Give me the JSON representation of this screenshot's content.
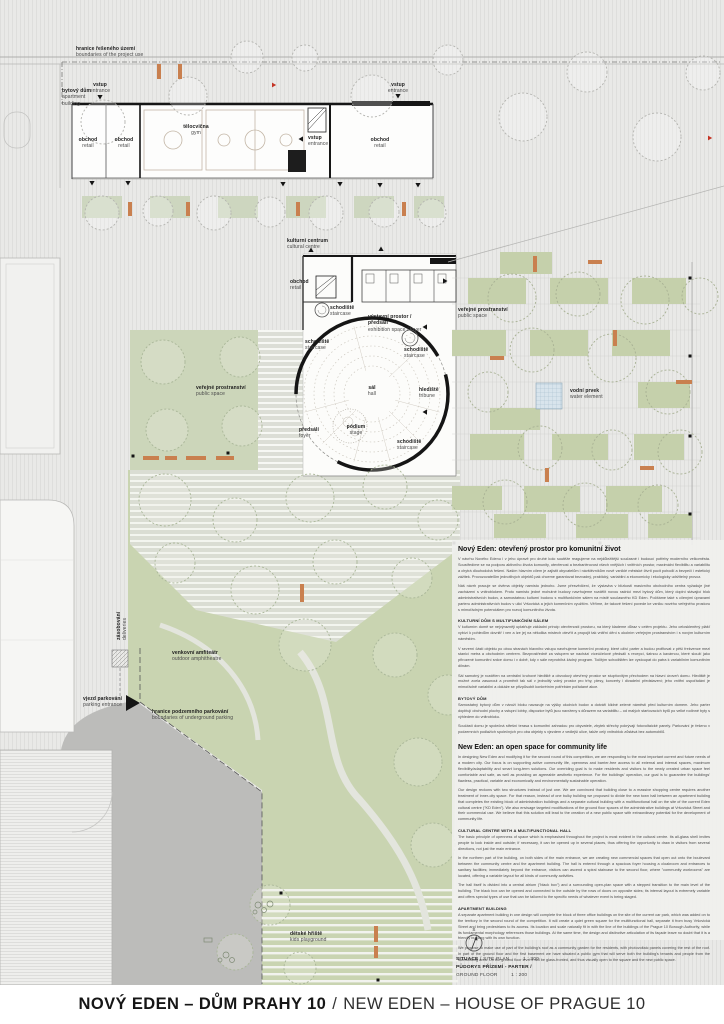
{
  "title_bar": {
    "cz": "NOVÝ EDEN – DŮM PRAHY 10",
    "separator": "/",
    "en": "NEW EDEN – HOUSE OF PRAGUE 10"
  },
  "scale_block": {
    "north_letter": "S",
    "situace_cz": "SITUACE",
    "situace_en": "/ SITE PLAN",
    "situace_scale": "1 : 300",
    "pudorys_cz": "PŮDORYS PŘÍZEMÍ - PARTER /",
    "pudorys_en": "GROUND FLOOR",
    "pudorys_scale": "1 : 200"
  },
  "plan": {
    "labels": [
      {
        "id": "project-boundary",
        "cz": "hranice řešeného území",
        "en": "boundaries of the project use",
        "x": 76,
        "y": 46
      },
      {
        "id": "apartment-building",
        "cz": "bytový dům",
        "en": "apartment building",
        "x": 62,
        "y": 88,
        "w": 34
      },
      {
        "id": "entrance-apartment",
        "cz": "vstup",
        "en": "entrance",
        "x": 100,
        "y": 82,
        "cls": "center"
      },
      {
        "id": "retail-1",
        "cz": "obchod",
        "en": "retail",
        "x": 88,
        "y": 137,
        "cls": "center"
      },
      {
        "id": "retail-2",
        "cz": "obchod",
        "en": "retail",
        "x": 124,
        "y": 137,
        "cls": "center"
      },
      {
        "id": "gym",
        "cz": "tělocvična",
        "en": "gym",
        "x": 196,
        "y": 124,
        "cls": "center"
      },
      {
        "id": "entrance-top-right",
        "cz": "vstup",
        "en": "entrance",
        "x": 398,
        "y": 82,
        "cls": "center"
      },
      {
        "id": "retail-3",
        "cz": "obchod",
        "en": "retail",
        "x": 380,
        "y": 137,
        "cls": "center"
      },
      {
        "id": "entrance-side",
        "cz": "vstup",
        "en": "entrance",
        "x": 308,
        "y": 135
      },
      {
        "id": "cultural-centre",
        "cz": "kulturní centrum",
        "en": "cultural centre",
        "x": 287,
        "y": 238
      },
      {
        "id": "retail-cc",
        "cz": "obchod",
        "en": "retail",
        "x": 290,
        "y": 279
      },
      {
        "id": "exhibition-space",
        "cz": "výstavní prostor / předsálí",
        "en": "exhibition space / foyer",
        "x": 368,
        "y": 314,
        "w": 62
      },
      {
        "id": "staircase-top",
        "cz": "schodiště",
        "en": "staircase",
        "x": 330,
        "y": 305
      },
      {
        "id": "staircase-left",
        "cz": "schodiště",
        "en": "staircase",
        "x": 305,
        "y": 339
      },
      {
        "id": "staircase-spiral",
        "cz": "schodiště",
        "en": "staircase",
        "x": 404,
        "y": 347
      },
      {
        "id": "tribune",
        "cz": "hlediště",
        "en": "tribune",
        "x": 419,
        "y": 387
      },
      {
        "id": "hall",
        "cz": "sál",
        "en": "hall",
        "x": 372,
        "y": 385,
        "cls": "center"
      },
      {
        "id": "stage",
        "cz": "pódium",
        "en": "stage",
        "x": 356,
        "y": 424,
        "cls": "center"
      },
      {
        "id": "foyer",
        "cz": "předsálí",
        "en": "foyer",
        "x": 299,
        "y": 427
      },
      {
        "id": "staircase-br",
        "cz": "schodiště",
        "en": "staircase",
        "x": 397,
        "y": 439
      },
      {
        "id": "public-space-right",
        "cz": "veřejné prostranství",
        "en": "public space",
        "x": 458,
        "y": 307
      },
      {
        "id": "public-space-left",
        "cz": "veřejné prostranství",
        "en": "public space",
        "x": 196,
        "y": 385
      },
      {
        "id": "water-element",
        "cz": "vodní prvek",
        "en": "water element",
        "x": 570,
        "y": 388
      },
      {
        "id": "deliveries",
        "cz": "zásobování",
        "en": "deliveries",
        "x": 116,
        "y": 640,
        "cls": "vert"
      },
      {
        "id": "outdoor-amphitheatre",
        "cz": "venkovní amfiteátr",
        "en": "outdoor amphitheatre",
        "x": 172,
        "y": 650
      },
      {
        "id": "parking-entrance",
        "cz": "vjezd parkování",
        "en": "parking entrance",
        "x": 58,
        "y": 696,
        "w": 64,
        "cls": "rightalign"
      },
      {
        "id": "underground-parking-boundary",
        "cz": "hranice podzemního parkování",
        "en": "boundaries of underground parking",
        "x": 152,
        "y": 709
      },
      {
        "id": "kids-playground",
        "cz": "dětské hřiště",
        "en": "kids playground",
        "x": 290,
        "y": 931
      }
    ]
  },
  "text_column": {
    "blocks": [
      {
        "type": "title",
        "text": "Nový Eden: otevřený prostor pro komunitní život"
      },
      {
        "type": "p",
        "text": "V návrhu Nového Edenu i v jeho úpravě pro druhé kolo soutěže reagujeme na nejdůležitější současné i budoucí potřeby moderního velkoměsta. Soustředíme se na podporu aktivního života komunity, otevřenost a bezbariérovost všech vnějších i vnitřních prostor, maximální flexibilitu a variabilitu a chytrá dlouhodobá řešení. Naším hlavním cílem je zajistit obyvatelům i návštěvníkům nově vzniklé městské čtvrti pocit pohodlí a bezpečí i estetický zážitek. Provozovatelům jednotlivých objektů pak chceme garantovat bezvadný, praktický, variabilní a ekonomicky i ekologicky udržitelný provoz."
      },
      {
        "type": "p",
        "text": "Náš návrh pracuje se dvěma objekty namísto jednoho. Jsme přesvědčeni, že výstavba v blízkosti masivního obchodního centra vyžaduje jiné zacházení s vnitroblokem. Proto namísto jedné mohutné budovy navrhujeme rozdělit novou radnici mezi bytový dům, který doplní stávající blok administrativních budov, a samostatnou kulturní budovu s multifunkčním sálem na místě současného KD Eden. Počítáme také s cílenými úpravami parteru administrativních budov v ulici Vršovická a jejich komerčním využitím. Věříme, že takové řešení povede ke vzniku nového veřejného prostoru s mimořádným potenciálem pro rozvoj komunitního života."
      },
      {
        "type": "h",
        "text": "KULTURNÍ DŮM S MULTIFUNKČNÍM SÁLEM"
      },
      {
        "type": "p",
        "text": "V kulturním domě se nejvýrazněji uplatňuje základní princip otevřenosti prostoru, na který klademe důraz v celém projektu. Jeho celoskleněný plášť vybízí k pohledům dovnitř i ven a lze jej na několika místech otevřít a propojit tak vnitřní dění s okolním veřejným prostranstvím i s novým kulturním náměstím."
      },
      {
        "type": "p",
        "text": "V severní části objektu po obou stranách hlavního vstupu navrhujeme komerční prostory, které oživí parter a budou profitovat z pěší frekvence mezi stanicí metra a obchodním centrem. Bezprostředně za vstupem se nachází víceúčelové předsálí s recepcí, šatnou a kavárnou, které slouží jako přirozené komunitní srdce domu i v době, kdy v sále neprobíhá žádný program. Točitým schodištěm lze vystoupat do patra k variabilním komunitním dílnám."
      },
      {
        "type": "p",
        "text": "Sál samotný je rozdělen na centrální kruhové hlediště a obvodový otevřený prostor se stupňovitým přechodem na hlavní úroveň domu. Hlediště je možné zcela zasunout a proměnit tak sál v jednolitý volný prostor pro trhy, plesy, koncerty i divadelní představení; jeho vnitřní uspořádání je mimořádně variabilní a dokáže se přizpůsobit konkrétním potřebám pořádané akce."
      },
      {
        "type": "h",
        "text": "BYTOVÝ DŮM"
      },
      {
        "type": "p",
        "text": "Samostatný bytový dům v nároží bloku navazuje na výšky okolních budov a dotváří klidné zelené náměstí před kulturním domem. Jeho parter doplňují obchodní plochy a vstupní lobby, dispozice bytů jsou navrženy s důrazem na variabilitu – od malých startovacích bytů po velké rodinné byty s výhledem do vnitrobloku."
      },
      {
        "type": "p",
        "text": "Součástí domu je společná střešní terasa s komunitní zahradou pro obyvatele, zbytek střechy pokrývají fotovoltaické panely. Parkování je řešeno v podzemních podlažích společných pro oba objekty s vjezdem z vedlejší ulice, takže celý vnitroblok zůstává bez automobilů."
      },
      {
        "type": "title",
        "text": "New Eden: an open space for community life"
      },
      {
        "type": "p",
        "text": "In designing New Eden and modifying it for the second round of this competition, we are responding to the most important current and future needs of a modern city. Our focus is on supporting active community life, openness and barrier-free access to all external and internal spaces, maximum flexibility/adaptability and smart long-term solutions. Our overriding goal is to make residents and visitors to the newly created urban space feel comfortable and safe, as well as providing an agreeable aesthetic experience. For the buildings' operation, our goal is to guarantee the buildings' flawless, practical, variable and economically and environmentally sustainable operation."
      },
      {
        "type": "p",
        "text": "Our design reckons with two structures instead of just one. We are convinced that building close to a massive shopping centre requires another treatment of inner-city space. For that reason, instead of one bulky building we proposed to divide the new town hall between an apartment building that completes the existing block of administration buildings and a separate cultural building with a multifunctional hall on the site of the current Eden cultural centre (\"KD Eden\"). We also envisage targeted modifications of the ground floor spaces of the administrative buildings at Vršovická Street and their commercial use. We believe that this solution will lead to the creation of a new public space with extraordinary potential for the development of community life."
      },
      {
        "type": "h",
        "text": "CULTURAL CENTRE WITH A MULTIFUNCTIONAL HALL"
      },
      {
        "type": "p",
        "text": "The basic principle of openness of space which is emphasised throughout the project is most evident in the cultural centre. Its all-glass shell invites people to look inside and outside; if necessary, it can be opened up in several places, thus offering the opportunity to draw in visitors from several directions, not just the main entrance."
      },
      {
        "type": "p",
        "text": "In the northern part of the building, on both sides of the main entrance, we are creating new commercial spaces that open out onto the boulevard between the community centre and the apartment building. The hall is entered through a spacious foyer housing a cloakroom and entrances to sanitary facilities; immediately beyond the entrance, visitors can ascend a spiral staircase to the second floor, where \"community workrooms\" are located, offering a variable layout for all kinds of community activities."
      },
      {
        "type": "p",
        "text": "The hall itself is divided into a central atrium (\"black box\") and a surrounding open-plan space with a stepped transition to the main level of the building. The black box can be opened and connected to the outside by the rows of doors on opposite sides; its internal layout is extremely variable and offers special types of use that can be tailored to the specific needs of whatever event is being staged."
      },
      {
        "type": "h",
        "text": "APARTMENT BUILDING"
      },
      {
        "type": "p",
        "text": "A separate apartment building in one design will complete the block of three office buildings on the site of the current car park, which was added on to the territory in the second round of the competition. It will create a quiet green square for the multifunctional hall, separate it from busy Vršovická Street and bring pedestrians to its access. Its location and scale naturally fit in with the line of the buildings of the Prague 10 Borough Authority, while its fundamental morphology references those buildings. At the same time, the design and distinctive articulation of its façade leave no doubt that it is a friendly building with its own function."
      },
      {
        "type": "p",
        "text": "We propose to make use of part of the building's roof as a community garden for the residents, with photovoltaic panels covering the rest of the roof. In part of the ground floor and the first basement we have situated a public gym that will serve both the building's tenants and people from the surrounding area. On the ground floor level it will be glass-fronted, and thus visually open to the square and the new public space."
      }
    ]
  }
}
